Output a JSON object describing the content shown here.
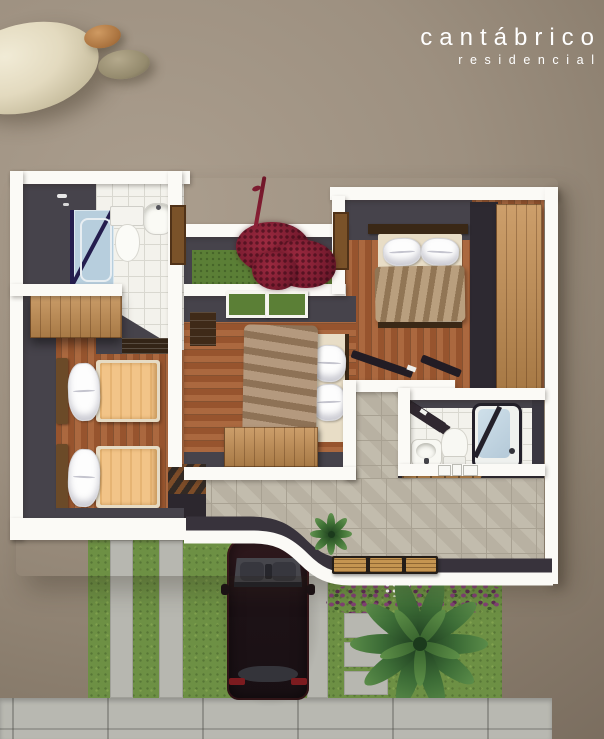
{
  "brand": {
    "name": "cantábrico",
    "tagline": "residencial",
    "text_color": "#ffffff"
  },
  "scene": {
    "type": "architectural-floor-plan-3d-render-top-view",
    "rooms": [
      "bathroom-1",
      "courtyard-garden",
      "master-bedroom",
      "twin-bedroom",
      "center-bedroom",
      "bathroom-2",
      "staircase",
      "stone-patio",
      "tiled-hallway"
    ],
    "furniture": [
      "shower",
      "toilet",
      "washbasin",
      "double-bed",
      "twin-bed",
      "twin-bed",
      "wardrobe",
      "closet",
      "dresser",
      "bathtub",
      "patio-bench",
      "stair-railing"
    ],
    "exterior": [
      "driveway-lawn",
      "concrete-strips",
      "parked-car",
      "palm-tree",
      "potted-palm",
      "flower-bed",
      "white-flowers",
      "stepping-stones",
      "sidewalk",
      "red-bougainvillea"
    ],
    "decor": [
      "pebble-large",
      "pebble-copper",
      "pebble-olive"
    ]
  },
  "palette": {
    "background_light": "#ab9e8e",
    "background_dark": "#786b5d",
    "wall_cap_white": "#fbfaf6",
    "wall_face_gray": "#46434b",
    "void_gray": "#2d2931",
    "wood_floor": "#a25c33",
    "closet_wood": "#c48e51",
    "bath_tile": "#f3f2ec",
    "patio_stone": "#bfb8a9",
    "grass_green": "#6d9044",
    "courtyard_grass": "#5b7f36",
    "plant_red": "#8c2036",
    "flower_purple": "#833f77",
    "palm_green": "#3c6c36",
    "blanket_tan": "#a5876a",
    "blanket_peach": "#f2c488",
    "bed_base_cream": "#e8ddc6",
    "car_body_maroon": "#241417",
    "concrete_gray": "#b7b7b0",
    "shower_glass_blue": "#b7cedd"
  }
}
